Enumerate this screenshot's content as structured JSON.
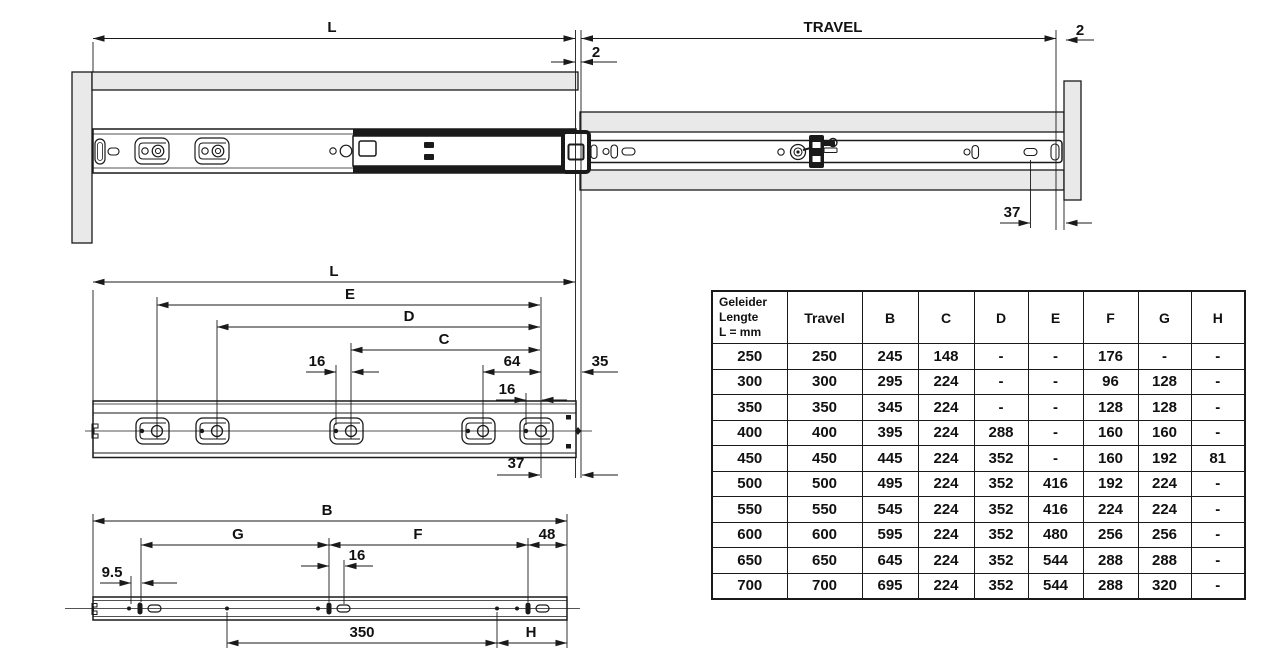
{
  "colors": {
    "ink": "#1a1a1a",
    "panel_fill": "#e9e9e9",
    "background": "#ffffff"
  },
  "views": {
    "top_extended_view": {
      "dim_length": "L",
      "dim_travel": "TRAVEL",
      "dim_rear_gap": "2",
      "dim_front_gap": "2",
      "dim_front_hole_offset": "37"
    },
    "cabinet_member_view": {
      "dim_length": "L",
      "dim_e": "E",
      "dim_d": "D",
      "dim_c": "C",
      "dim_hole_pitch_mid": "16",
      "dim_64": "64",
      "dim_hole_pitch_front": "16",
      "dim_35": "35",
      "dim_37": "37"
    },
    "drawer_member_view": {
      "dim_b": "B",
      "dim_g": "G",
      "dim_f": "F",
      "dim_48": "48",
      "dim_hole_pitch": "16",
      "dim_9_5": "9.5",
      "dim_350": "350",
      "dim_h": "H"
    }
  },
  "table": {
    "col0_header_lines": [
      "Geleider",
      "Lengte",
      "L = mm"
    ],
    "headers": [
      "Travel",
      "B",
      "C",
      "D",
      "E",
      "F",
      "G",
      "H"
    ],
    "rows": [
      [
        "250",
        "250",
        "245",
        "148",
        "-",
        "-",
        "176",
        "-",
        "-"
      ],
      [
        "300",
        "300",
        "295",
        "224",
        "-",
        "-",
        "96",
        "128",
        "-"
      ],
      [
        "350",
        "350",
        "345",
        "224",
        "-",
        "-",
        "128",
        "128",
        "-"
      ],
      [
        "400",
        "400",
        "395",
        "224",
        "288",
        "-",
        "160",
        "160",
        "-"
      ],
      [
        "450",
        "450",
        "445",
        "224",
        "352",
        "-",
        "160",
        "192",
        "81"
      ],
      [
        "500",
        "500",
        "495",
        "224",
        "352",
        "416",
        "192",
        "224",
        "-"
      ],
      [
        "550",
        "550",
        "545",
        "224",
        "352",
        "416",
        "224",
        "224",
        "-"
      ],
      [
        "600",
        "600",
        "595",
        "224",
        "352",
        "480",
        "256",
        "256",
        "-"
      ],
      [
        "650",
        "650",
        "645",
        "224",
        "352",
        "544",
        "288",
        "288",
        "-"
      ],
      [
        "700",
        "700",
        "695",
        "224",
        "352",
        "544",
        "288",
        "320",
        "-"
      ]
    ]
  }
}
